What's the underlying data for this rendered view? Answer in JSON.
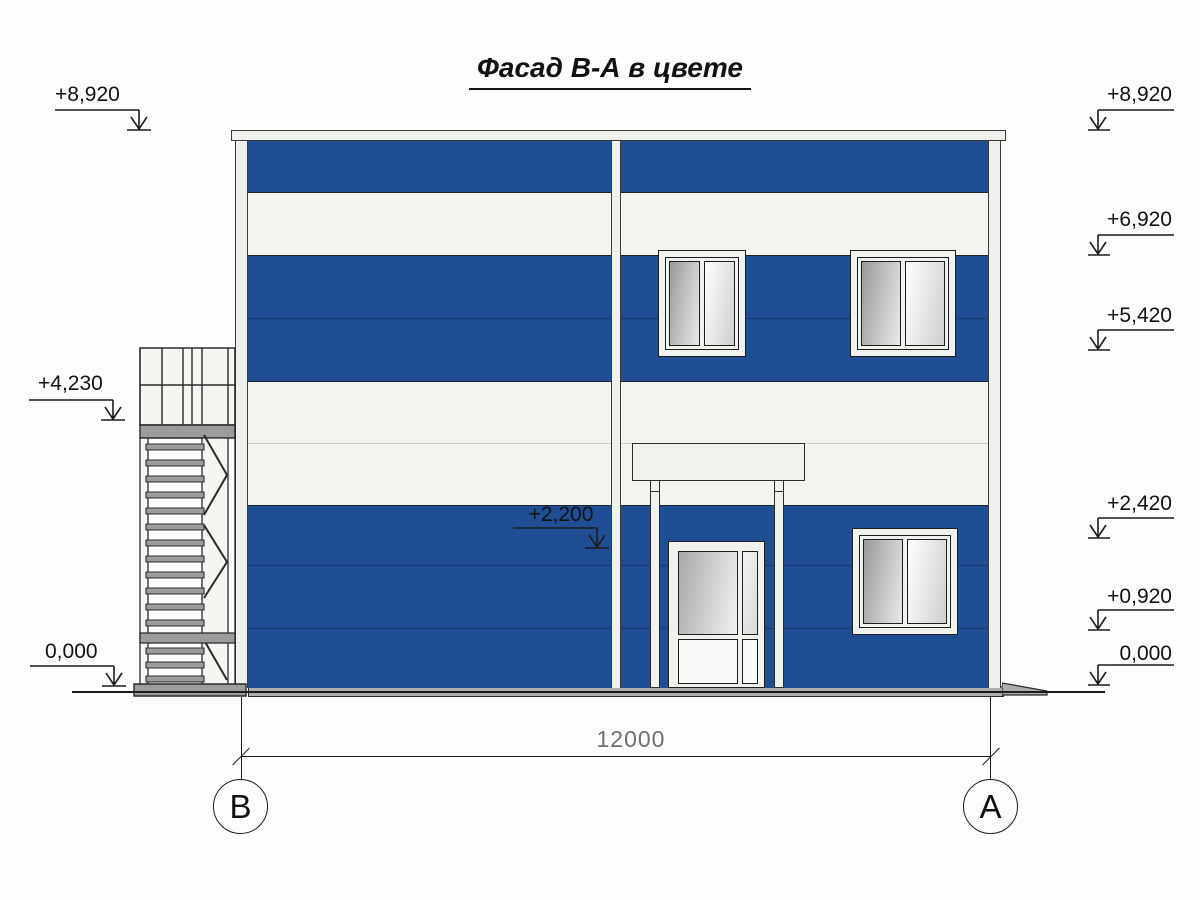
{
  "title": "Фасад В-А в цвете",
  "marks": {
    "left": [
      {
        "label": "+8,920"
      },
      {
        "label": "+4,230"
      },
      {
        "label": "0,000"
      }
    ],
    "mid": {
      "label": "+2,200"
    },
    "right": [
      {
        "label": "+8,920"
      },
      {
        "label": "+6,920"
      },
      {
        "label": "+5,420"
      },
      {
        "label": "+2,420"
      },
      {
        "label": "+0,920"
      },
      {
        "label": "0,000"
      }
    ]
  },
  "dimension": {
    "length": "12000"
  },
  "axes": {
    "left_label": "В",
    "right_label": "А"
  },
  "facade": {
    "stripe_pattern": [
      "blue",
      "white",
      "blue",
      "white",
      "blue"
    ],
    "windows_count": 3,
    "doors_count": 1,
    "colors": {
      "panel_blue": "#1f4e95",
      "panel_white": "#f2f4ef",
      "joint_blue": "#16396b",
      "metal_gray": "#9c9c9c",
      "outline": "#1d1d1d"
    }
  }
}
